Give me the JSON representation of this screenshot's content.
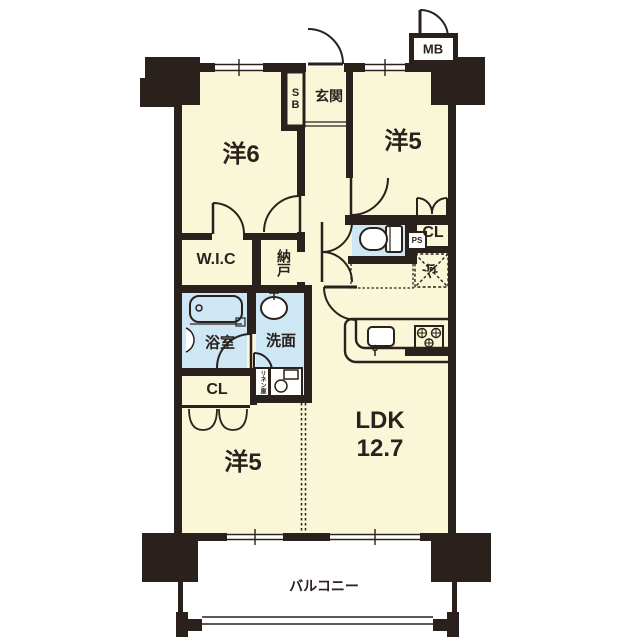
{
  "plan": {
    "type": "apartment-floor-plan",
    "colors": {
      "wall": "#2b211c",
      "floor": "#faf6d8",
      "wet_area": "#cde7f4",
      "background": "#ffffff"
    },
    "rooms": {
      "western6": {
        "label": "洋6"
      },
      "western5_upper": {
        "label": "洋5"
      },
      "western5_lower": {
        "label": "洋5"
      },
      "ldk": {
        "label": "LDK",
        "area": "12.7"
      },
      "entrance": {
        "label": "玄関"
      },
      "shoe_box": {
        "label": "SB"
      },
      "meter_box": {
        "label": "MB"
      },
      "wic": {
        "label": "W.I.C"
      },
      "storage": {
        "label": "納戸"
      },
      "closet_upper": {
        "label": "CL"
      },
      "closet_lower": {
        "label": "CL"
      },
      "pipe_space": {
        "label": "PS"
      },
      "refrigerator": {
        "label": "冷"
      },
      "bathroom": {
        "label": "浴室"
      },
      "washroom": {
        "label": "洗面"
      },
      "linen": {
        "label": "リネン庫"
      },
      "balcony": {
        "label": "バルコニー"
      }
    }
  }
}
